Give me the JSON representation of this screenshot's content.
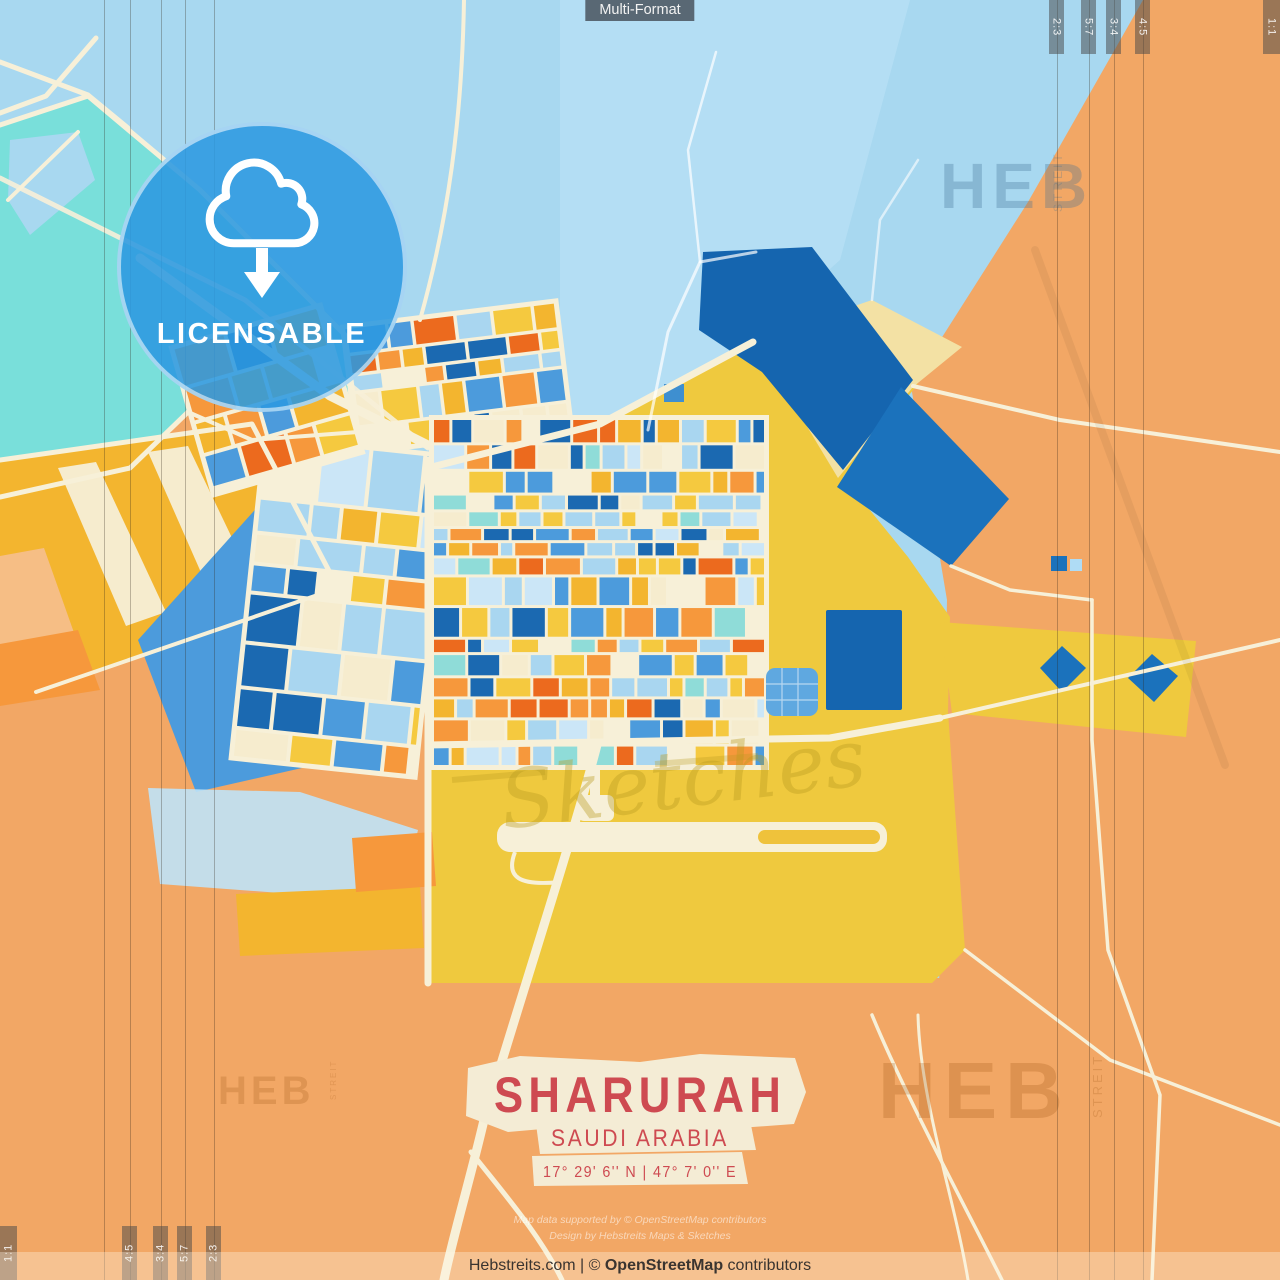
{
  "chip": {
    "label": "Multi-Format"
  },
  "badge": {
    "label": "LICENSABLE",
    "icon": "cloud-download"
  },
  "title_block": {
    "city": "SHARURAH",
    "country": "SAUDI ARABIA",
    "coordinates": "17° 29' 6'' N | 47° 7' 0'' E"
  },
  "credits": {
    "line1": "Map data supported by © OpenStreetMap contributors",
    "line2": "Design by Hebstreits Maps & Sketches"
  },
  "footer": {
    "prefix": "Hebstreits.com | © ",
    "osm": "OpenStreetMap",
    "suffix": " contributors"
  },
  "format_marks": {
    "top_right": [
      "2:3",
      "5:7",
      "3:4",
      "4:5"
    ],
    "top_right_corner": "1:1",
    "bottom_left": [
      "4:5",
      "3:4",
      "5:7",
      "2:3"
    ],
    "bottom_left_corner": "1:1"
  },
  "watermarks": {
    "heb": "HEB",
    "streit": "STREIT",
    "sketches": "Sketches"
  },
  "colors": {
    "water": "#A8D8F0",
    "water_light": "#BCE3F6",
    "cyan": "#79DFDA",
    "land_orange": "#F2A765",
    "yellow_district": "#EFC93E",
    "beige": "#F3E1A4",
    "road_cream": "#F7F0D8",
    "runway_accent": "#EFC23B",
    "band_blue": "#1565AF",
    "diamond_blue": "#1B72BC",
    "wedge_blue": "#4C9BDC",
    "badge_blue": "#2C99E0",
    "title_red": "#CE4A51",
    "title_cream": "#F4ECD5",
    "palette": {
      "lb": "#A9D6F0",
      "pale": "#CBE6F7",
      "med": "#4C9BDC",
      "dark": "#1B69B1",
      "teal": "#8FDCD8",
      "yellow": "#F5C93F",
      "gold": "#F3B52F",
      "cream": "#F6ECCE",
      "orange": "#F6983C",
      "red": "#EC6A1E",
      "peach": "#F6BE85"
    }
  }
}
